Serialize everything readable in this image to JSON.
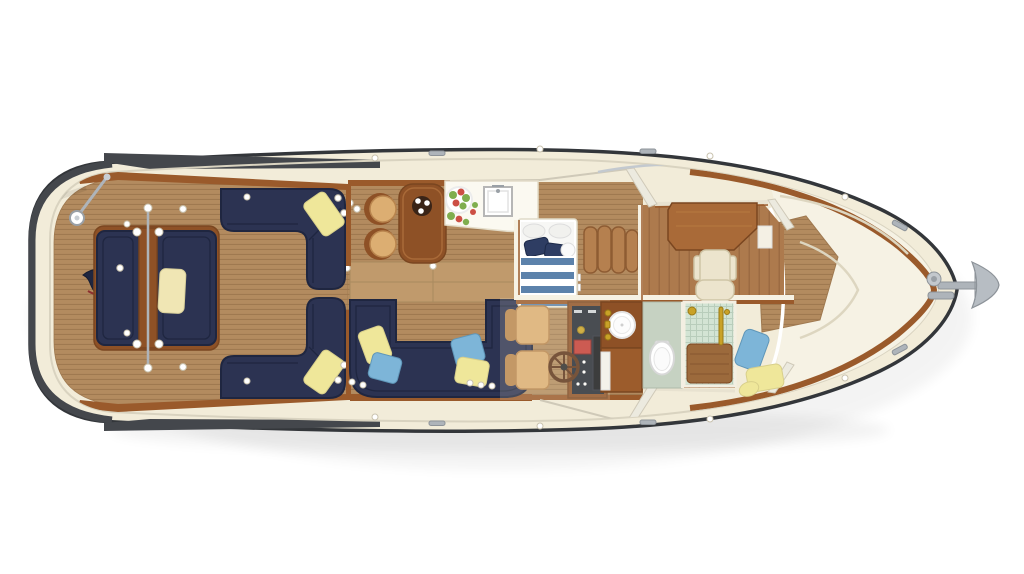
{
  "scene": {
    "type": "yacht-deck-plan-top-view",
    "description": "Overhead floor plan rendering of a motor yacht, bow to the right",
    "background": "#ffffff"
  },
  "areas": [
    "aft-deck",
    "stern-bench",
    "port-aft-sofa",
    "starboard-aft-sofa",
    "ensign-flag",
    "salon",
    "dinette-table",
    "dinette-stools",
    "galley-counter",
    "galley-sink",
    "fruit-bowl",
    "u-shaped-sofa",
    "helm-station",
    "helm-chairs",
    "steering-wheel",
    "instrument-console",
    "master-bed",
    "settee-cushions",
    "vanity-desk",
    "desk-chair",
    "head-vanity-sink",
    "toilet",
    "shower",
    "bow-lounge",
    "bow-pillows",
    "anchor"
  ],
  "colors": {
    "hull_outline": "#33363a",
    "hull_band": "#44474c",
    "deck_cream": "#f2ecd9",
    "inner_line": "#d9d3c0",
    "caprail": "#9a5a2b",
    "trim_dark": "#7a4620",
    "teak": "#b38b5f",
    "teak_line": "#9f7950",
    "teak_fwd": "#ad7a4d",
    "teak_fwd_line": "#976740",
    "teak_step": "#c09a6c",
    "navy": "#2c3352",
    "navy_dark": "#1f2640",
    "wood": "#8e5126",
    "wood_light": "#a96a38",
    "tan": "#dcae72",
    "tan_dark": "#b9854e",
    "cream_pillow": "#f0e6b4",
    "yellow": "#efe79a",
    "blue": "#7db5d8",
    "off_white": "#f6f2e4",
    "bed_blue": "#5c82ab",
    "bed_navy": "#2e3d63",
    "settee": "#b5804f",
    "settee_dark": "#8e5c33",
    "tile": "#d3e4d4",
    "tile_line": "#b8cdbb",
    "head_floor": "#c6d2c2",
    "gold": "#c9a227",
    "metal": "#aeb4ba",
    "metal_dark": "#8d9399",
    "red": "#c43b35",
    "console": "#242a35",
    "chair_cream": "#ece4cd",
    "chair_cream_dark": "#cfc5a6"
  }
}
